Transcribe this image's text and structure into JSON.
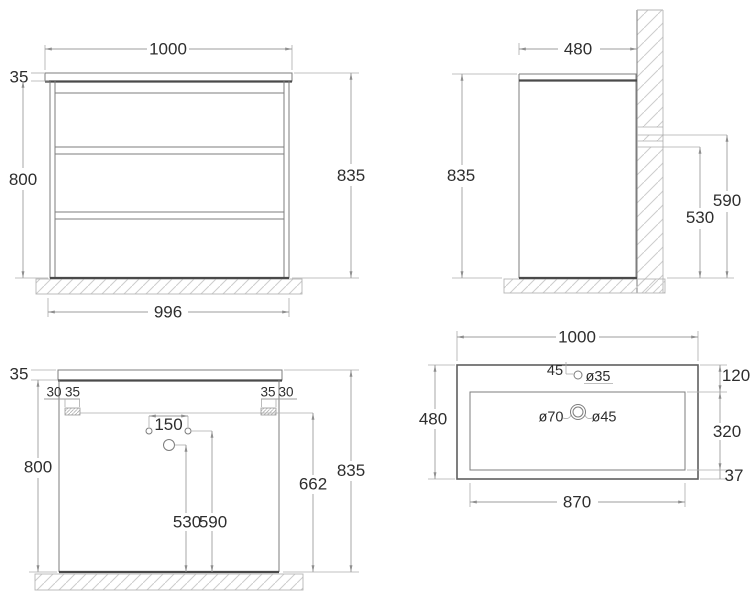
{
  "drawing": {
    "front": {
      "width": "1000",
      "top_thickness": "35",
      "body_height": "800",
      "total_height": "835",
      "base_width": "996"
    },
    "side": {
      "depth": "480",
      "total_height": "835",
      "upper_connection_height": "590",
      "lower_connection_height": "530"
    },
    "back": {
      "top_thickness": "35",
      "left_bracket_offset": "30",
      "left_bracket_width": "35",
      "right_bracket_width": "35",
      "right_bracket_offset": "30",
      "hole_spacing": "150",
      "body_height": "800",
      "bracket_height": "662",
      "total_height": "835",
      "siphon_hole_height": "530",
      "side_hole_height": "590"
    },
    "sink": {
      "width": "1000",
      "tap_hole_offset": "45",
      "tap_hole_diameter": "ø35",
      "back_edge": "120",
      "depth": "480",
      "drain_outer_diameter": "ø70",
      "drain_inner_diameter": "ø45",
      "basin_depth": "320",
      "front_edge": "37",
      "basin_width": "870"
    },
    "colors": {
      "object_line": "#7d7d7d",
      "accent_line": "#4a4a4a",
      "dimension_line": "#9e9e9e",
      "text": "#2e2e2e",
      "hatch": "#cdcdcd",
      "background": "#ffffff"
    }
  }
}
